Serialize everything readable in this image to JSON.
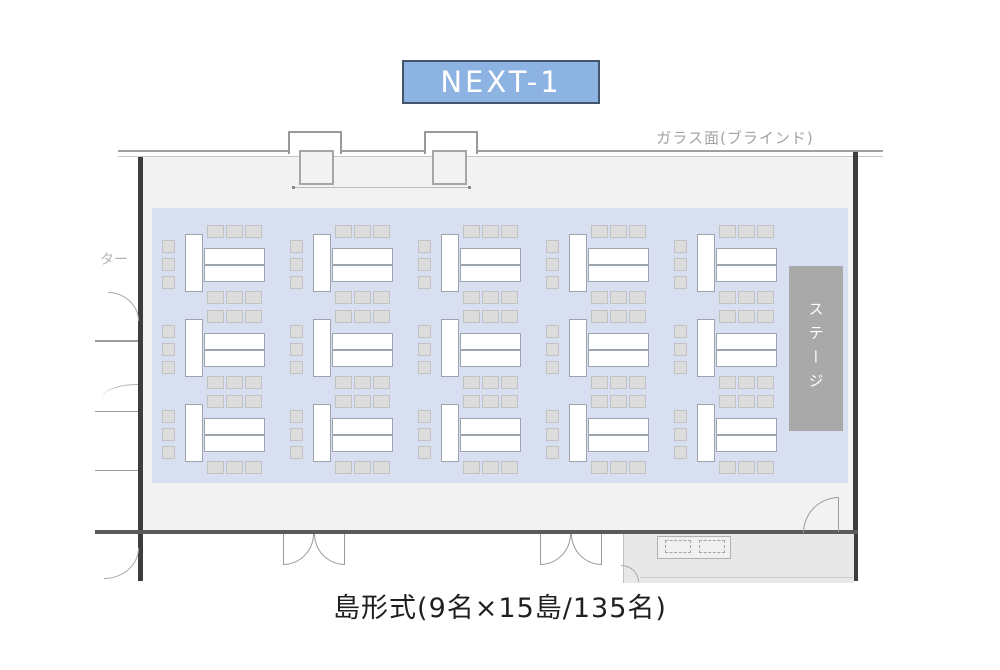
{
  "title": {
    "label": "NEXT-1",
    "fill_color": "#8db3e2",
    "border_color": "#44546a",
    "text_color": "#ffffff"
  },
  "labels": {
    "glass_wall": "ガラス面(ブラインド)",
    "stage": "ステージ",
    "left_edge_partial": "ター",
    "caption": "島形式(9名×15島/135名)"
  },
  "floor_plan": {
    "layout_name": "島形式",
    "seats_per_island": 9,
    "island_count": 15,
    "total_capacity": 135,
    "islands": {
      "rows": 3,
      "cols": 5,
      "chairs_left": 3,
      "chairs_top": 3,
      "chairs_bottom": 3,
      "tables_vertical": 1,
      "tables_horizontal": 2
    },
    "colors": {
      "seating_area": "#d7dff0",
      "chair": "#dcdcdc",
      "table": "#ffffff",
      "stage": "#a9a9a9",
      "room_floor": "#f2f2f2"
    }
  }
}
